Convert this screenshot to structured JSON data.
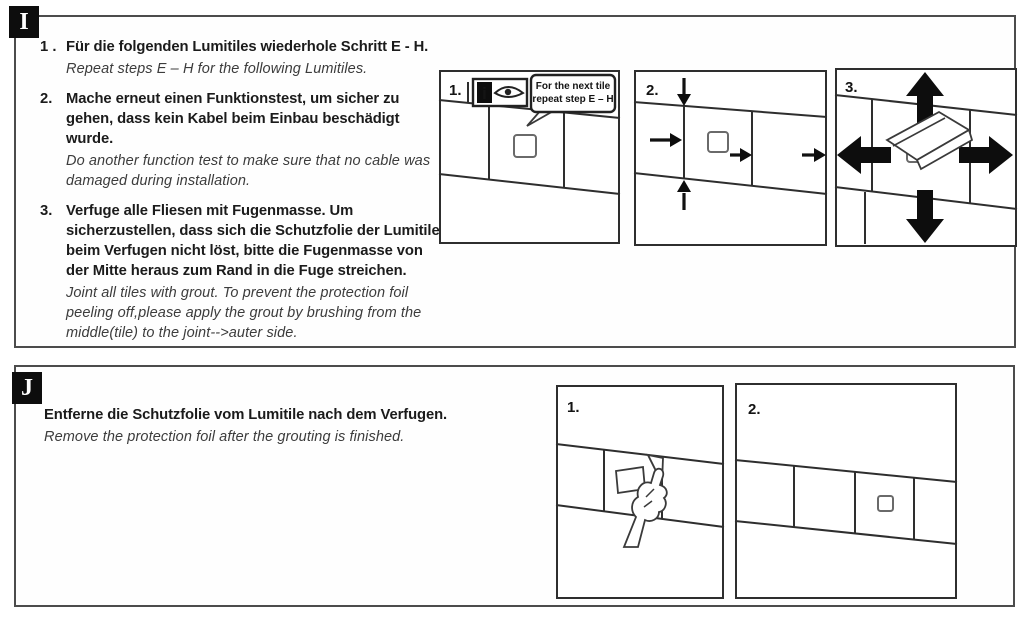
{
  "section_i": {
    "label": "I",
    "items": [
      {
        "num": "1 .",
        "de": "Für die folgenden Lumitiles wiederhole Schritt E - H.",
        "en": "Repeat steps E – H  for the following Lumitiles."
      },
      {
        "num": "2.",
        "de": "Mache erneut einen Funktionstest, um sicher zu gehen, dass kein Kabel beim Einbau beschädigt wurde.",
        "en": "Do another function test to make sure that no cable was damaged during installation."
      },
      {
        "num": "3.",
        "de": "Verfuge alle Fliesen mit Fugenmasse. Um sicherzustellen, dass sich die Schutzfolie der Lumitiles beim Verfugen nicht löst, bitte die Fugenmasse von der Mitte heraus zum Rand in die Fuge streichen.",
        "en": "Joint all tiles with grout. To prevent the protection foil peeling off,please apply the grout by brushing from the middle(tile) to the joint-->auter side."
      }
    ],
    "panels": [
      {
        "num": "1.",
        "info_letter": "i",
        "callout": [
          "For the next tile",
          "repeat step E – H"
        ]
      },
      {
        "num": "2."
      },
      {
        "num": "3."
      }
    ]
  },
  "section_j": {
    "label": "J",
    "de": "Entferne die Schutzfolie vom Lumitile nach dem Verfugen.",
    "en": "Remove the protection foil after the grouting is finished.",
    "panels": [
      {
        "num": "1."
      },
      {
        "num": "2."
      }
    ]
  },
  "colors": {
    "line": "#2e2e2e",
    "badge_bg": "#0d0d0d",
    "border": "#4c4c4c"
  }
}
